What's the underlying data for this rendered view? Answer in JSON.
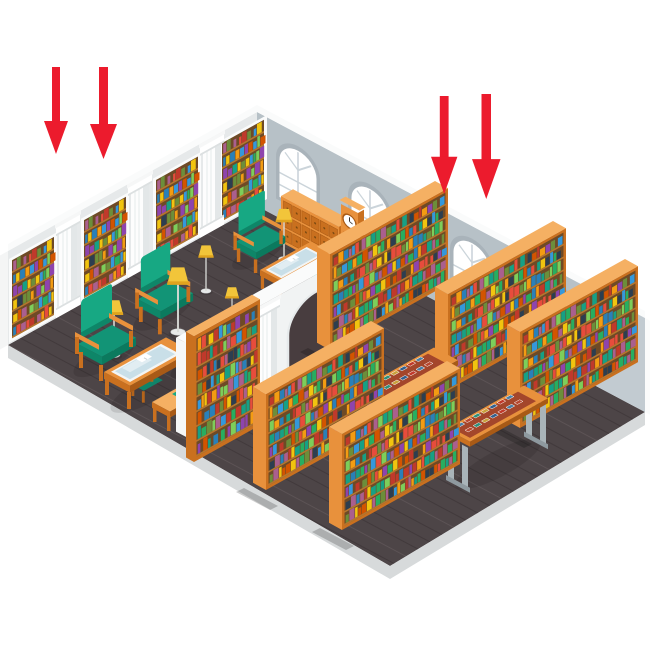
{
  "meta": {
    "title": "Isometric library interior illustration",
    "type": "vector illustration, no visible text",
    "background": "#FFFFFF"
  },
  "annotations": {
    "arrows": {
      "direction": "down",
      "style": "solid straight shaft with triangular head",
      "groups": [
        {
          "position": "top-left, above reading room",
          "count": 2
        },
        {
          "position": "top-right, above book stacks",
          "count": 2
        }
      ]
    }
  },
  "scene": {
    "setting": "cutaway isometric library split into two rooms by a white wall with an arched doorway",
    "left_room": {
      "name": "reading room",
      "wall_bookcases": 4,
      "wall_columns": 3,
      "arched_windows": 2,
      "armchairs": 3,
      "side_chairs": 2,
      "benches": 2,
      "coffee_tables_with_open_books": 3,
      "floor_lamps": 6,
      "card_catalog_cabinet": 1,
      "grandfather_clock": 1,
      "small_drawer_cabinet": 1,
      "writing_desk": 1
    },
    "divider": {
      "type": "white interior wall with arched doorway",
      "columns": 2,
      "attached_tall_bookcase": 1
    },
    "right_room": {
      "name": "book stacks",
      "arched_windows": 2,
      "freestanding_bookcases": 5,
      "book_display_tables": 2
    },
    "floor": "dark wooden planks",
    "walls": "light grey with white trim"
  },
  "palette": {
    "white": "#FFFFFF",
    "red": "#EC1B2D",
    "floor": "#4D4547",
    "floor-line-dark": "#423A3C",
    "floor-line-light": "#5C5355",
    "rim": "#D7DADB",
    "left-wall": "#E6E9EA",
    "back-wall": "#B7C1C7",
    "back-wall-dark": "#C2CBD1",
    "divider": "#F1F3F3",
    "wall-white": "#FAFBFB",
    "win-frame": "#A9B3BA",
    "win-bar": "#CBD4DA",
    "glass": "#C9DFE8",
    "wood": "#E8913C",
    "wood-light": "#F5B063",
    "wood-dark": "#C9701F",
    "wood-deep": "#A85A16",
    "shelf-bg": "#6E4A26",
    "shelf-board": "#B5762E",
    "green": "#17A883",
    "green-mid": "#129476",
    "green-dark": "#0E8668",
    "green-deep": "#0B7A5E",
    "yellow": "#F2C53A",
    "yellow-dark": "#DFA31E",
    "metal": "#A9B4B9",
    "metal-dark": "#8E999F",
    "display-bed": "#A4462B",
    "arch-dark": "#483D3F"
  },
  "books": {
    "colors": [
      "#C0392B",
      "#27AE60",
      "#2980B9",
      "#8E44AD",
      "#F39C12",
      "#16A085",
      "#D35400",
      "#2C3E50",
      "#7DCE5A",
      "#E74C3C",
      "#3498DB",
      "#F1C40F",
      "#6C8E3A",
      "#AA5F8E"
    ],
    "cover_colors": [
      "#4A7FA5",
      "#B8472F",
      "#2F8F7A",
      "#C8A13C",
      "#32608E",
      "#C0392B"
    ],
    "shelf_rows": 7
  }
}
